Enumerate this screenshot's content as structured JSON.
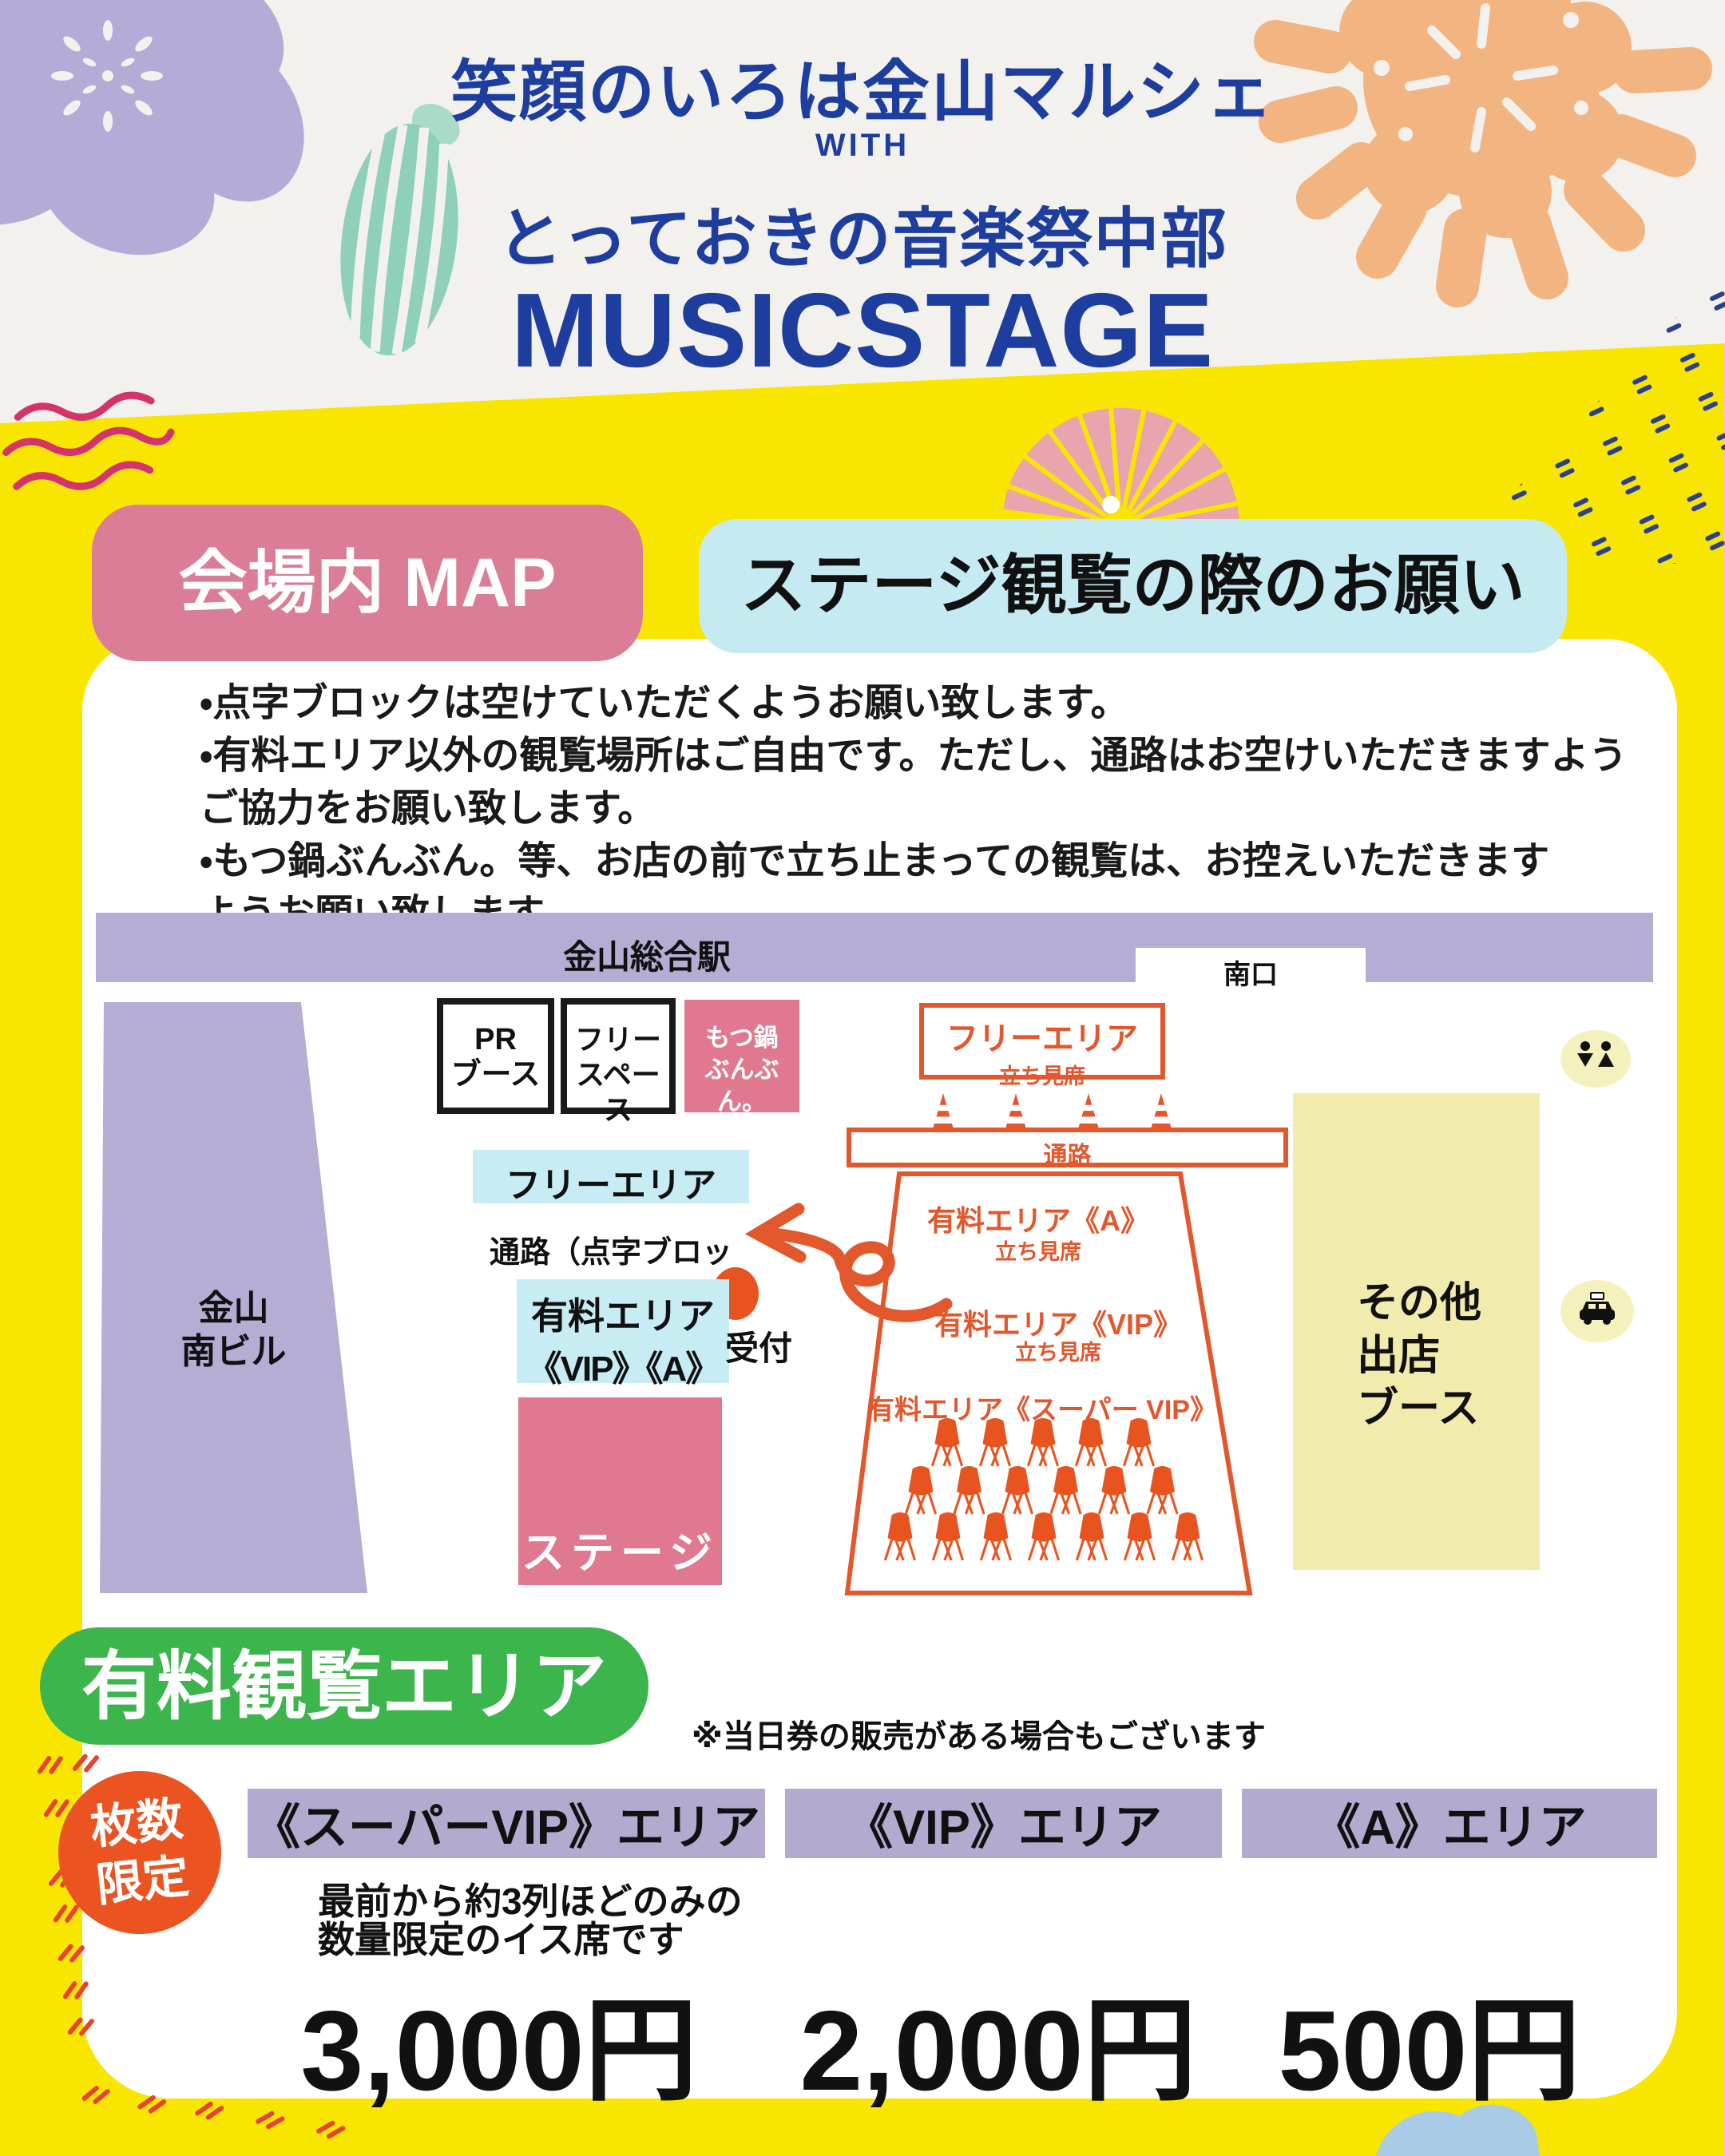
{
  "title": {
    "line1": "笑顔のいろは金山マルシェ",
    "with": "WITH",
    "line2": "とっておきの音楽祭中部",
    "main": "MUSICSTAGE"
  },
  "section": {
    "map_badge": "会場内 MAP",
    "notice_badge": "ステージ観覧の際のお願い"
  },
  "notices": [
    "・点字ブロックは空けていただくようお願い致します。",
    "・有料エリア以外の観覧場所はご自由です。ただし、通路はお空けいただきますよう",
    "ご協力をお願い致します。",
    "・もつ鍋ぶんぶん。等、お店の前で立ち止まっての観覧は、お控えいただきます",
    "ようお願い致します。"
  ],
  "map": {
    "station": "金山総合駅",
    "south_exit": "南口",
    "building": [
      "金山",
      "南ビル"
    ],
    "pr_booth": [
      "PR",
      "ブース"
    ],
    "free_space": [
      "フリー",
      "スペース"
    ],
    "motsunabe": [
      "もつ鍋",
      "ぶんぶん。"
    ],
    "free_area_stand": {
      "title": "フリーエリア",
      "sub": "立ち見席"
    },
    "aisle": "通路",
    "free_area": "フリーエリア",
    "braille_path": "通路（点字ブロック）",
    "paid_area": [
      "有料エリア",
      "《VIP》《A》"
    ],
    "reception": "受付",
    "stage": "ステージ",
    "paid_a": {
      "title": "有料エリア《A》",
      "sub": "立ち見席"
    },
    "paid_vip": {
      "title": "有料エリア《VIP》",
      "sub": "立ち見席"
    },
    "paid_svip": {
      "title": "有料エリア《スーパー VIP》"
    },
    "other_booth": [
      "その他",
      "出店",
      "ブース"
    ],
    "chair_rows": [
      5,
      6,
      7
    ],
    "cone_count": 4,
    "icons": [
      "restroom-icon",
      "taxi-icon"
    ]
  },
  "pricing": {
    "badge": "有料観覧エリア",
    "note": "※当日券の販売がある場合もございます",
    "limited": [
      "枚数",
      "限定"
    ],
    "areas": [
      {
        "name": "《スーパーVIP》エリア",
        "price": "3,000円"
      },
      {
        "name": "《VIP》エリア",
        "price": "2,000円"
      },
      {
        "name": "《A》エリア",
        "price": "500円"
      }
    ],
    "svip_desc": [
      "最前から約3列ほどのみの",
      "数量限定のイス席です"
    ]
  },
  "colors": {
    "page_yellow": "#f9e600",
    "header_gray": "#f3f1ee",
    "title_navy": "#1d3e9e",
    "badge_pink": "#db7d97",
    "badge_blue": "#c6eaf2",
    "lavender": "#b7acd4",
    "cyan_box": "#c8ecf4",
    "pink_box": "#e0798f",
    "map_orange": "#e2572b",
    "booth_yellow": "#f1ecae",
    "green_badge": "#3cb54c",
    "orange_circle": "#eb5321",
    "area_bar_purple": "#b4aacf"
  }
}
